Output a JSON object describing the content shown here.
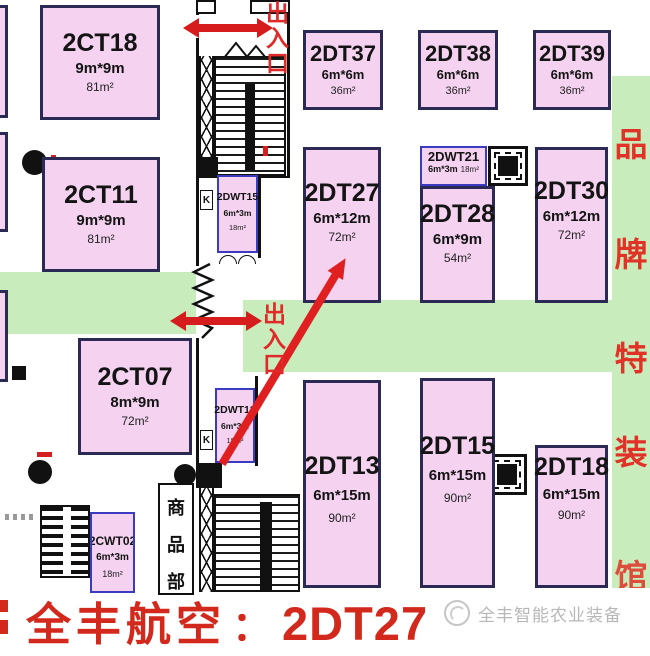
{
  "booths": {
    "ct18": {
      "name": "2CT18",
      "dims": "9m*9m",
      "area": "81m²"
    },
    "ct11": {
      "name": "2CT11",
      "dims": "9m*9m",
      "area": "81m²"
    },
    "ct07": {
      "name": "2CT07",
      "dims": "8m*9m",
      "area": "72m²"
    },
    "dt37": {
      "name": "2DT37",
      "dims": "6m*6m",
      "area": "36m²"
    },
    "dt38": {
      "name": "2DT38",
      "dims": "6m*6m",
      "area": "36m²"
    },
    "dt39": {
      "name": "2DT39",
      "dims": "6m*6m",
      "area": "36m²"
    },
    "dt27": {
      "name": "2DT27",
      "dims": "6m*12m",
      "area": "72m²"
    },
    "dwt21": {
      "name": "2DWT21",
      "dims": "6m*3m",
      "area": "18m²"
    },
    "dt28": {
      "name": "2DT28",
      "dims": "6m*9m",
      "area": "54m²"
    },
    "dt30": {
      "name": "2DT30",
      "dims": "6m*12m",
      "area": "72m²"
    },
    "dt13": {
      "name": "2DT13",
      "dims": "6m*15m",
      "area": "90m²"
    },
    "dt15": {
      "name": "2DT15",
      "dims": "6m*15m",
      "area": "90m²"
    },
    "dt18": {
      "name": "2DT18",
      "dims": "6m*15m",
      "area": "90m²"
    },
    "dwt15": {
      "name": "2DWT15",
      "dims": "6m*3m",
      "area": "18m²"
    },
    "dwt13": {
      "name": "2DWT13",
      "dims": "6m*3m",
      "area": "18m²"
    },
    "cwt02": {
      "name": "2CWT02",
      "dims": "6m*3m",
      "area": "18m²"
    }
  },
  "labels": {
    "entrance_top": [
      "出",
      "入",
      "口"
    ],
    "entrance_mid": [
      "出",
      "入",
      "口"
    ],
    "side_banner": [
      "品",
      "牌",
      "特",
      "装",
      "馆"
    ],
    "shop_dept": [
      "商",
      "品",
      "部"
    ],
    "stair_k_upper": "K",
    "stair_k_lower": "K"
  },
  "highlight": {
    "exhibitor": "全丰航空",
    "colon": "：",
    "booth": "2DT27"
  },
  "watermark": {
    "text": "全丰智能农业装备"
  },
  "colors": {
    "booth_fill": "#f4d2f0",
    "booth_border": "#2a2a55",
    "small_booth_border": "#3b3bc0",
    "aisle_green": "#c9ecbc",
    "highlight_red": "#d3291d",
    "banner_red": "#e03226",
    "watermark_gray": "#b7b7b7"
  }
}
